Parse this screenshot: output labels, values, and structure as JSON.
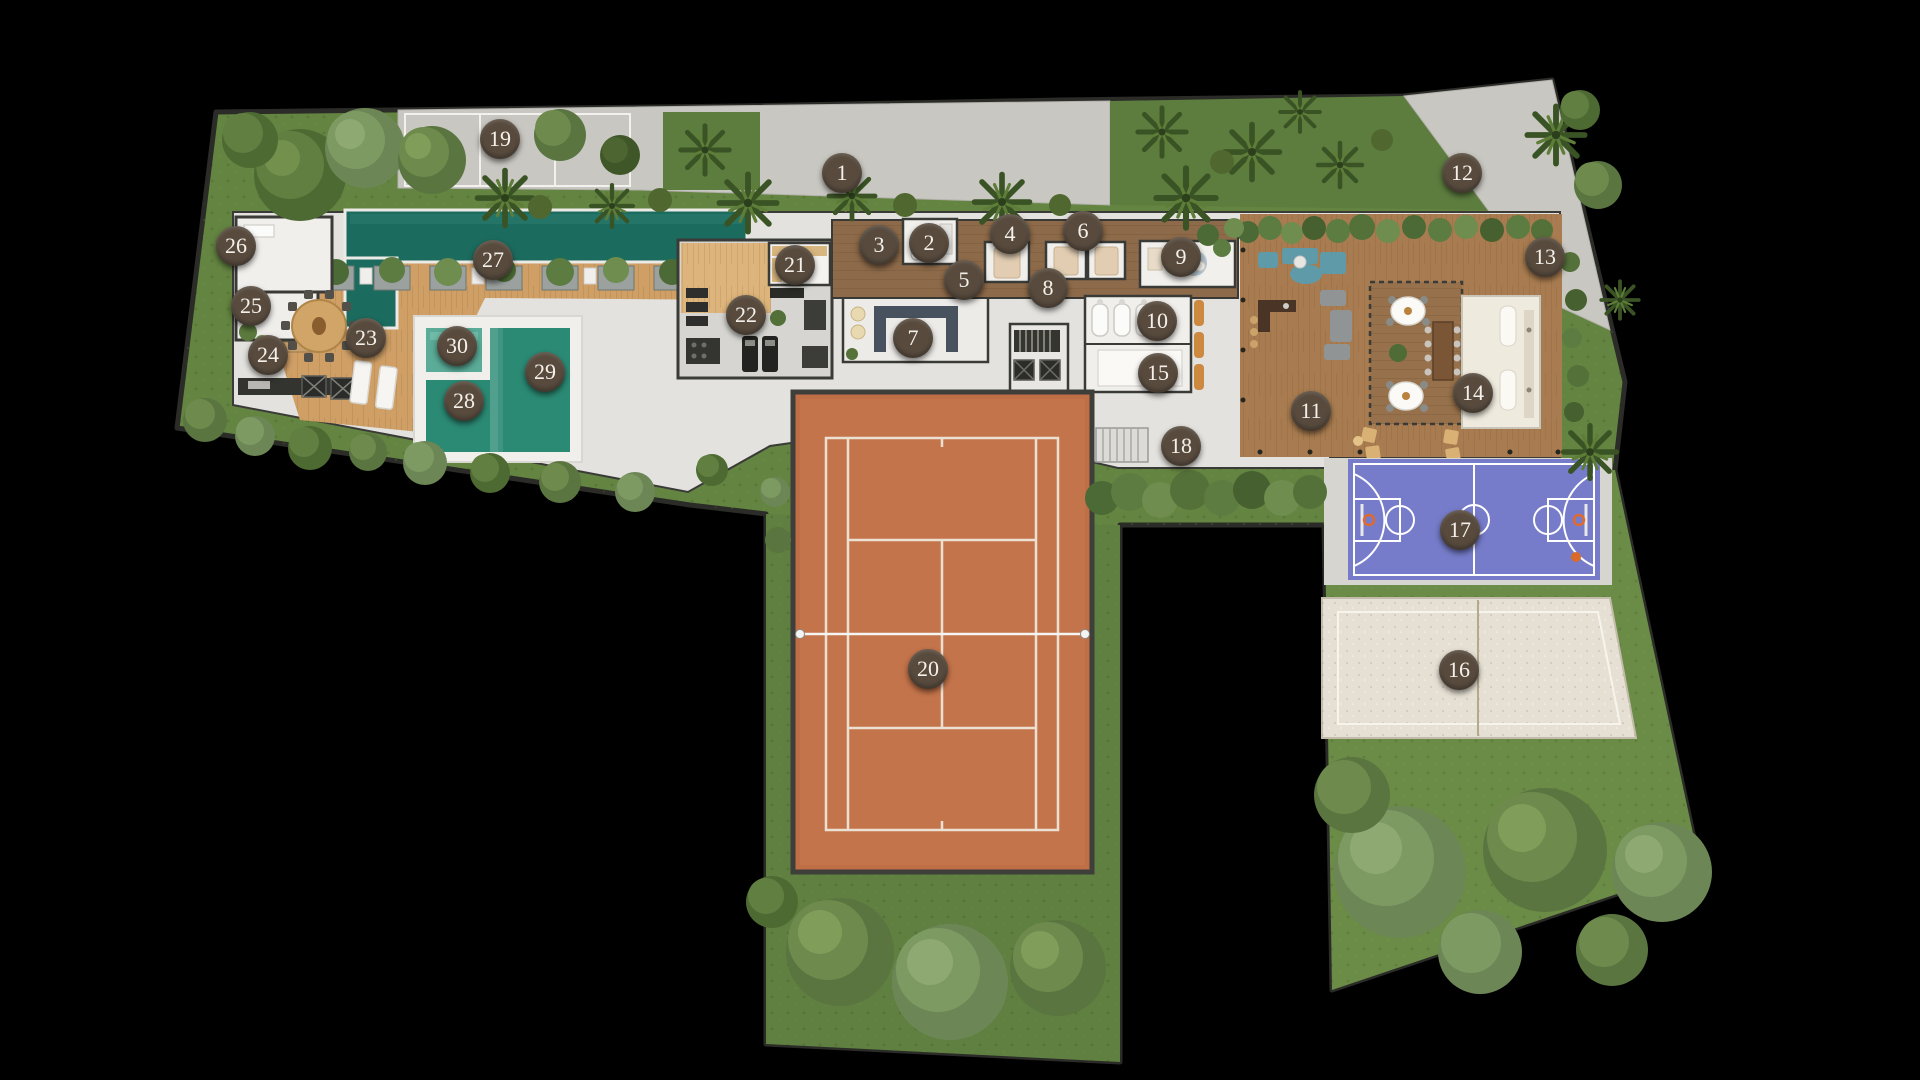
{
  "markers": [
    {
      "label": "1",
      "x": 842,
      "y": 173
    },
    {
      "label": "2",
      "x": 929,
      "y": 243
    },
    {
      "label": "3",
      "x": 879,
      "y": 245
    },
    {
      "label": "4",
      "x": 1010,
      "y": 234
    },
    {
      "label": "5",
      "x": 964,
      "y": 280
    },
    {
      "label": "6",
      "x": 1083,
      "y": 231
    },
    {
      "label": "7",
      "x": 913,
      "y": 338
    },
    {
      "label": "8",
      "x": 1048,
      "y": 288
    },
    {
      "label": "9",
      "x": 1181,
      "y": 257
    },
    {
      "label": "10",
      "x": 1157,
      "y": 321
    },
    {
      "label": "11",
      "x": 1311,
      "y": 411
    },
    {
      "label": "12",
      "x": 1462,
      "y": 173
    },
    {
      "label": "13",
      "x": 1545,
      "y": 257
    },
    {
      "label": "14",
      "x": 1473,
      "y": 393
    },
    {
      "label": "15",
      "x": 1158,
      "y": 373
    },
    {
      "label": "16",
      "x": 1459,
      "y": 670
    },
    {
      "label": "17",
      "x": 1460,
      "y": 530
    },
    {
      "label": "18",
      "x": 1181,
      "y": 446
    },
    {
      "label": "19",
      "x": 500,
      "y": 139
    },
    {
      "label": "20",
      "x": 928,
      "y": 669
    },
    {
      "label": "21",
      "x": 795,
      "y": 265
    },
    {
      "label": "22",
      "x": 746,
      "y": 315
    },
    {
      "label": "23",
      "x": 366,
      "y": 338
    },
    {
      "label": "24",
      "x": 268,
      "y": 355
    },
    {
      "label": "25",
      "x": 251,
      "y": 306
    },
    {
      "label": "26",
      "x": 236,
      "y": 246
    },
    {
      "label": "27",
      "x": 493,
      "y": 260
    },
    {
      "label": "28",
      "x": 464,
      "y": 401
    },
    {
      "label": "29",
      "x": 545,
      "y": 372
    },
    {
      "label": "30",
      "x": 457,
      "y": 346
    }
  ],
  "icons": {
    "accessible_parking": "♿"
  },
  "palette": {
    "background": "#000000",
    "grass": "#648441",
    "grass_dark": "#5d7d3f",
    "grass_light": "#6b8c46",
    "concrete": "#c9c7c1",
    "floor": "#e3e2de",
    "wall": "#3a3a37",
    "wood_deck": "#cf9f66",
    "wood_hall": "#8d6a49",
    "deck_right": "#a87c50",
    "pavilion": "#96714b",
    "lap_pool": "#1c6b5f",
    "pool_main": "#2b8a74",
    "pool_kids": "#5aab97",
    "tennis": "#bf6e45",
    "tennis_line": "#ece0d2",
    "basketball": "#767cc9",
    "basketball_line": "#ffffff",
    "sand": "#e6e0d4",
    "marker_bg": "#584b3e",
    "marker_text": "#f5f1ea"
  }
}
